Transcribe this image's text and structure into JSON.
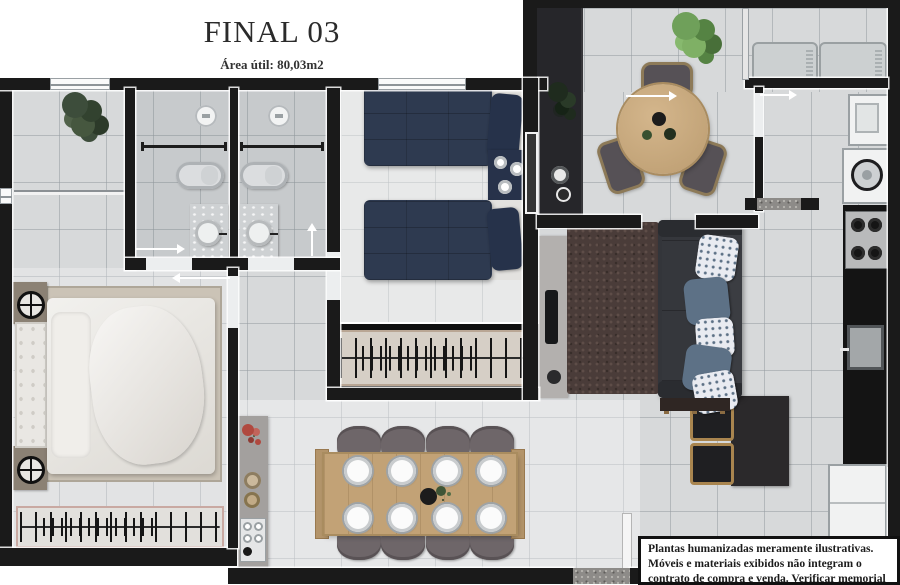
{
  "header": {
    "title": "FINAL 03",
    "area_label": "Área útil: 80,03m2"
  },
  "disclaimer": {
    "text": "Plantas humanizadas meramente ilustrativas. Móveis e materiais exibidos não integram o contrato de compra e venda. Verificar memorial descritivo."
  },
  "colors": {
    "wall": "#1a1a1a",
    "floor": "#d7d9da",
    "navy": "#2e3a50",
    "navy_dark": "#26324a",
    "wood": "#c2a276",
    "sofa": "#33353a",
    "rug_living": "#4a3c39",
    "rug_master": "#cbc3b6"
  }
}
